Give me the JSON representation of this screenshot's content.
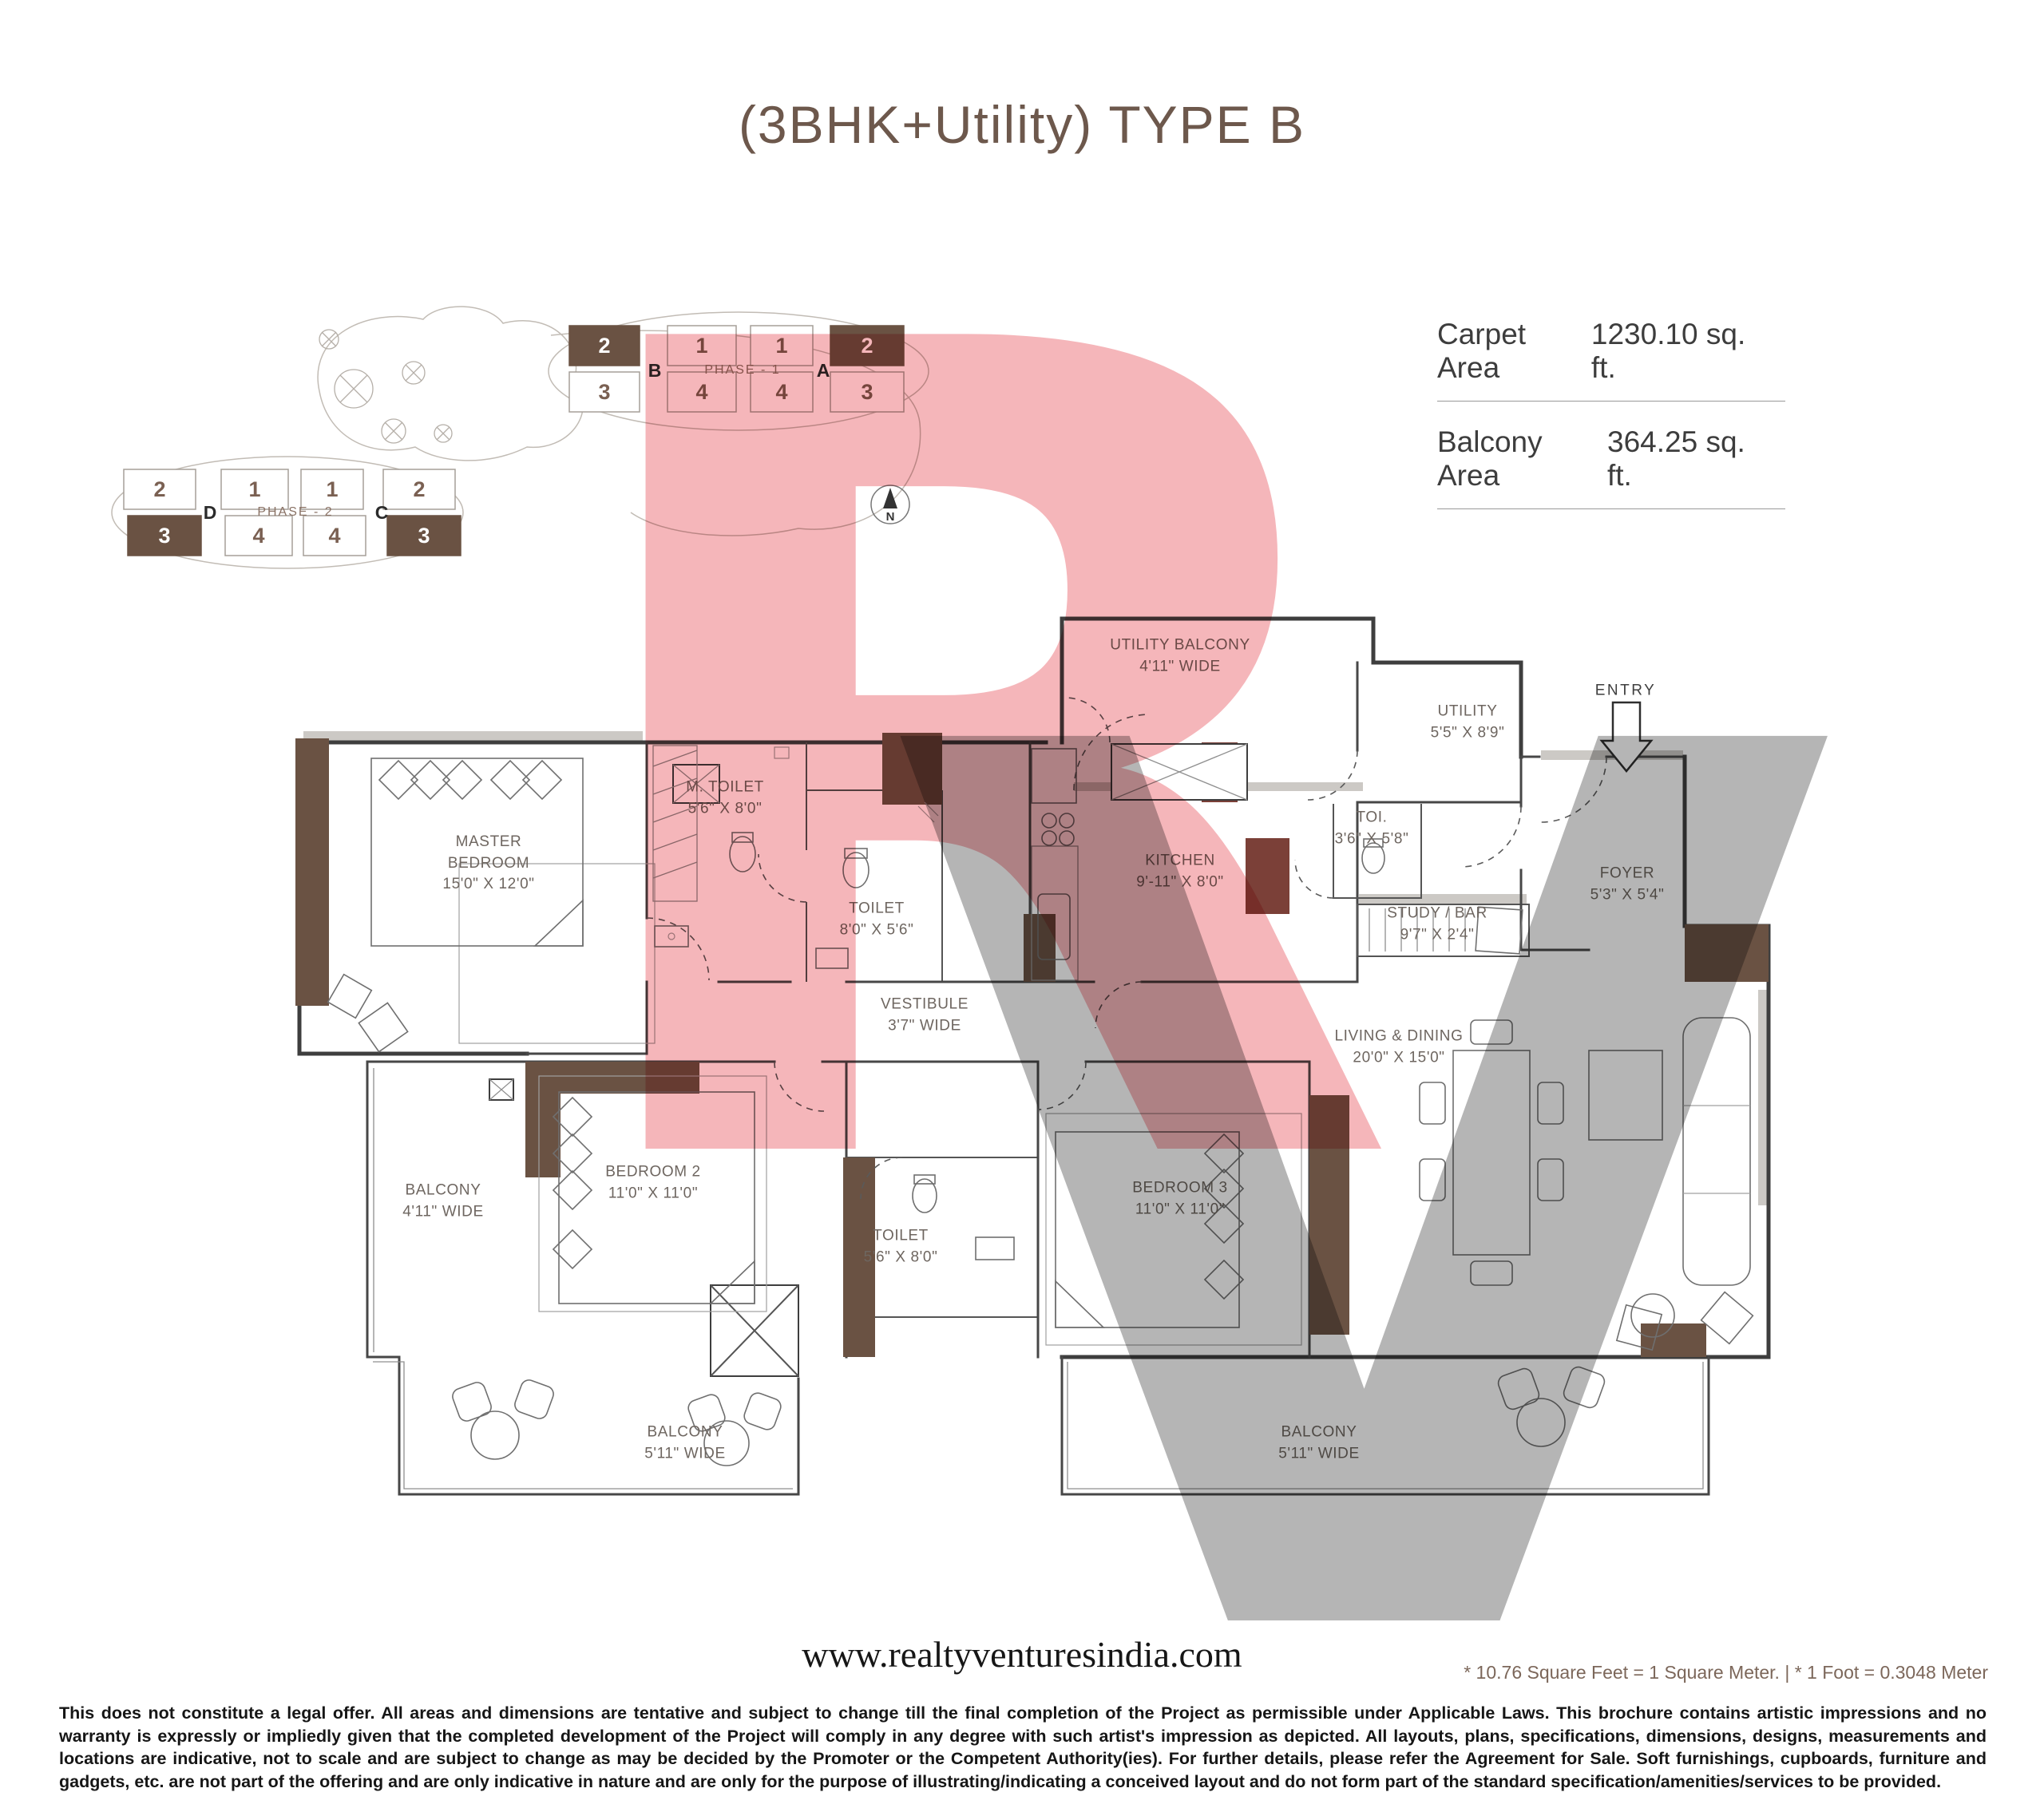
{
  "title": "(3BHK+Utility) TYPE B",
  "areas": {
    "carpet_label": "Carpet Area",
    "carpet_value": "1230.10 sq. ft.",
    "balcony_label": "Balcony Area",
    "balcony_value": "364.25 sq. ft."
  },
  "site_plan": {
    "phase1": {
      "label": "PHASE - 1",
      "towers": [
        "B",
        "A"
      ],
      "top_units": [
        "2",
        "1",
        "1",
        "2"
      ],
      "bottom_units": [
        "3",
        "4",
        "4",
        "3"
      ]
    },
    "phase2": {
      "label": "PHASE - 2",
      "towers": [
        "D",
        "C"
      ],
      "top_units": [
        "2",
        "1",
        "1",
        "2"
      ],
      "bottom_units": [
        "3",
        "4",
        "4",
        "3"
      ]
    },
    "north": "N"
  },
  "floor_plan": {
    "entry_label": "ENTRY",
    "rooms": [
      {
        "name": "UTILITY BALCONY",
        "dims": "4'11\" WIDE"
      },
      {
        "name": "UTILITY",
        "dims": "5'5\" X 8'9\""
      },
      {
        "name": "MASTER BEDROOM",
        "dims": "15'0\" X 12'0\""
      },
      {
        "name": "M. TOILET",
        "dims": "5'6\" X 8'0\""
      },
      {
        "name": "TOILET",
        "dims": "8'0\" X 5'6\""
      },
      {
        "name": "KITCHEN",
        "dims": "9'-11\" X 8'0\""
      },
      {
        "name": "TOI.",
        "dims": "3'6\" X 5'8\""
      },
      {
        "name": "STUDY / BAR",
        "dims": "9'7\" X 2'4\""
      },
      {
        "name": "FOYER",
        "dims": "5'3\" X 5'4\""
      },
      {
        "name": "VESTIBULE",
        "dims": "3'7\" WIDE"
      },
      {
        "name": "LIVING & DINING",
        "dims": "20'0\" X 15'0\""
      },
      {
        "name": "BEDROOM 2",
        "dims": "11'0\" X 11'0\""
      },
      {
        "name": "BEDROOM 3",
        "dims": "11'0\" X 11'0\""
      },
      {
        "name": "TOILET",
        "dims": "5'6\" X 8'0\""
      },
      {
        "name": "BALCONY",
        "dims": "4'11\" WIDE"
      },
      {
        "name": "BALCONY",
        "dims": "5'11\" WIDE"
      },
      {
        "name": "BALCONY",
        "dims": "5'11\" WIDE"
      }
    ]
  },
  "watermark": {
    "letter_r": "R",
    "letter_v": "V",
    "pink": "#f2a6aa",
    "gray": "#a9a9a9"
  },
  "footer": {
    "website": "www.realtyventuresindia.com",
    "conversion_note": "*  10.76 Square Feet = 1 Square Meter. | * 1 Foot = 0.3048 Meter",
    "disclaimer": "This does not constitute a legal offer. All areas and dimensions are tentative and subject to change till the final completion of the Project as permissible under Applicable Laws. This brochure contains artistic impressions and no warranty is expressly or impliedly given that the completed development of the Project will comply in any degree with such artist's impression as depicted. All layouts, plans, specifications, dimensions, designs, measurements and locations are indicative, not to scale and are subject to change as may be decided by the Promoter or the Competent Authority(ies). For further details, please refer the Agreement for Sale. Soft furnishings, cupboards, furniture and gadgets, etc. are not part of the offering and are only indicative in nature and are only for the purpose of illustrating/indicating a conceived layout and do not form part of the standard specification/amenities/services to be provided."
  }
}
